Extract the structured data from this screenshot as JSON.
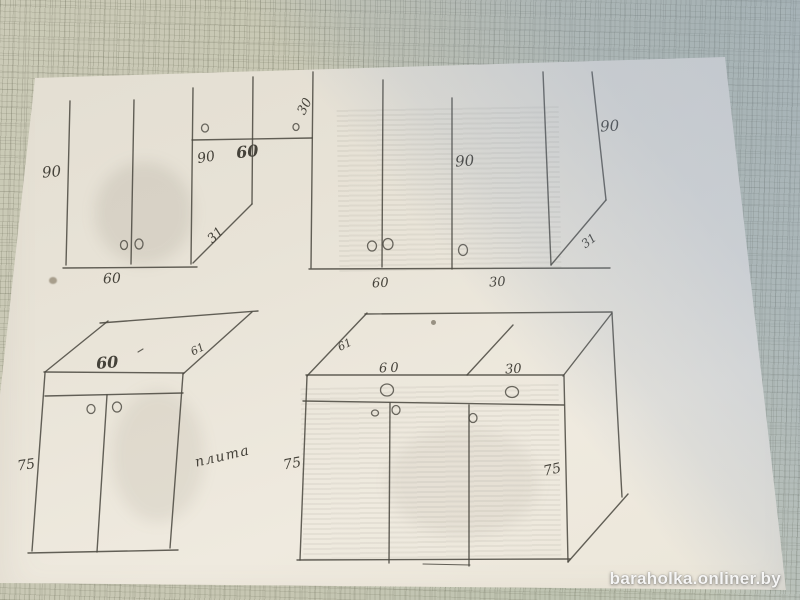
{
  "photo": {
    "watermark": "baraholka.onliner.by",
    "handwritten_note": "плита"
  },
  "sketch": {
    "wall_cabinet_left": {
      "height": "90",
      "width": "60"
    },
    "wall_corner_unit": {
      "inner_width": "90",
      "shelf_width": "60",
      "diagonal_cut": "31",
      "top_depth": "30"
    },
    "wall_cabinet_right": {
      "mid_height": "90",
      "back_height": "90",
      "diagonal_cut": "31",
      "door_width": "60",
      "shelf_width": "30"
    },
    "base_cabinet_left": {
      "top_width": "60",
      "top_depth": "61",
      "height": "75"
    },
    "base_cabinet_right": {
      "top_depth": "61",
      "left_width": "60",
      "right_width": "30",
      "front_height": "75",
      "back_height": "75"
    }
  }
}
